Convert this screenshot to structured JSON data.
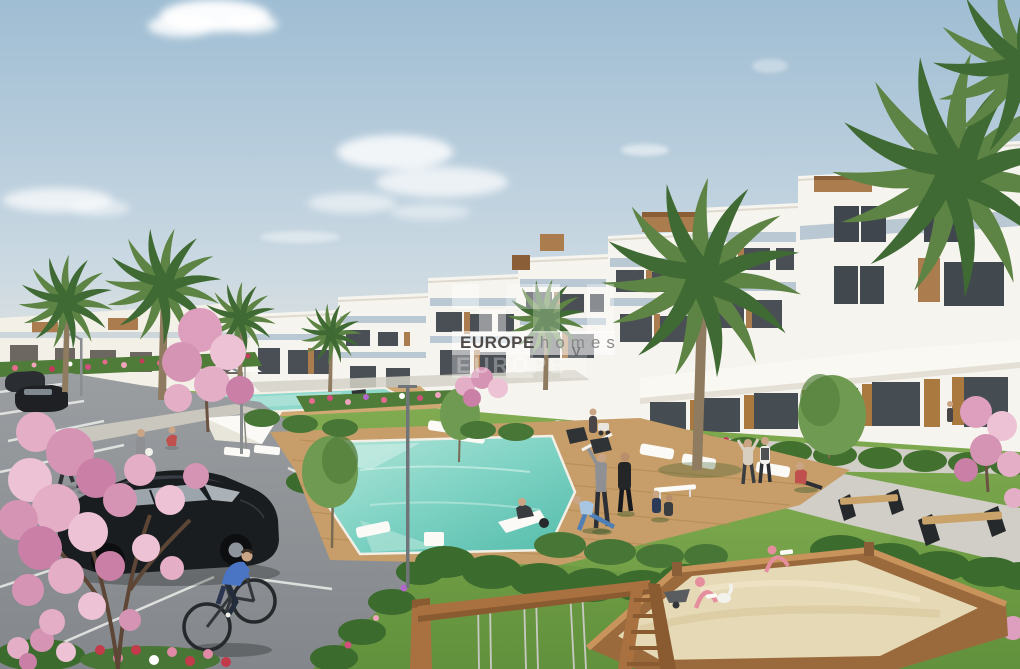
{
  "scene": {
    "type": "architectural_render",
    "description": "New-build white terraced apartment complex with communal gardens, two turquoise pools, a wooden sun deck, palm and cherry-blossom trees, residents exercising on the lawn, a parking lot with a black hatchback and a cyclist, benches along a walkway, a children's sandbox with pink spring toys and a wooden swing frame.",
    "watermark": {
      "brand_bold": "EUROPE",
      "brand_light": "homes",
      "mark": "V",
      "ghost_text": "EUROPE"
    },
    "colors": {
      "sky_top": "#9fbdd3",
      "sky_mid": "#c9d8e2",
      "sky_horizon": "#ece8de",
      "cloud_white": "#ffffff",
      "building_white": "#f6f4ee",
      "building_shade": "#ddd8cc",
      "glass_dark": "#41484e",
      "balcony_glass": "#b9c8d2",
      "wood_accent": "#ab7c4e",
      "wood_dark": "#8a5f38",
      "palm_light": "#5d8444",
      "palm_dark": "#3f6a33",
      "trunk_brown": "#8f7b60",
      "grass_light": "#83ad52",
      "grass_dark": "#61913c",
      "hedge_green": "#3c6b2e",
      "pool_light": "#b5e6da",
      "pool_mid": "#7fd3c4",
      "pool_deep": "#54bcab",
      "deck_wood": "#c79e6a",
      "path_gray": "#d0cec6",
      "asphalt_gray": "#8f9396",
      "marking_white": "#e8e9e6",
      "sand_beige": "#e6d9b6",
      "blossom_pink": "#dd9fbd",
      "car_black": "#1a1d20",
      "toy_pink": "#e58f9e",
      "brand_dark_gray": "#4f4a47",
      "brand_light_gray": "#8a8a8a"
    }
  }
}
